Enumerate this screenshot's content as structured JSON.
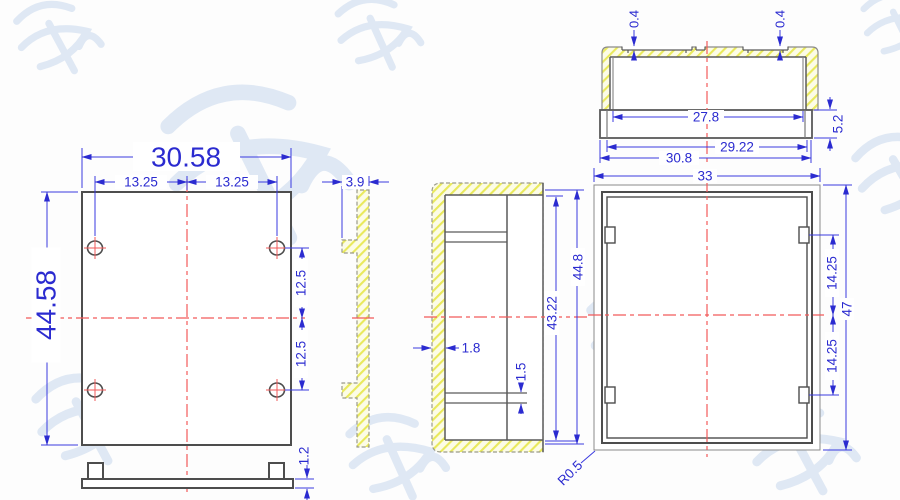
{
  "drawing": {
    "front_view": {
      "width": "30.58",
      "pitch_left": "13.25",
      "pitch_right": "13.25",
      "height": "44.58",
      "hole_offset_upper": "12.5",
      "hole_offset_lower": "12.5",
      "base_thickness": "1.2"
    },
    "side_view": {
      "flange_depth": "3.9"
    },
    "section_view": {
      "wall_thickness": "1.8",
      "slot_gap": "1.5",
      "inner_depth": "43.22",
      "outer_depth": "44.8"
    },
    "top_view": {
      "groove_depth_a": "0.4",
      "groove_depth_b": "0.4",
      "inner_width": "27.8",
      "step_width": "29.22",
      "outer_width": "30.8",
      "collar_height": "5.2"
    },
    "end_view": {
      "width": "33",
      "height": "47",
      "slot_offset_upper": "14.25",
      "slot_offset_lower": "14.25",
      "corner_radius": "R0.5"
    }
  },
  "colors": {
    "dimension_blue": "#2b2bd0",
    "outline_gray": "#4d4d4d",
    "centerline_red": "#f25a5a",
    "hatch_yellow": "#e9e95c",
    "watermark": "#dce6f3"
  }
}
